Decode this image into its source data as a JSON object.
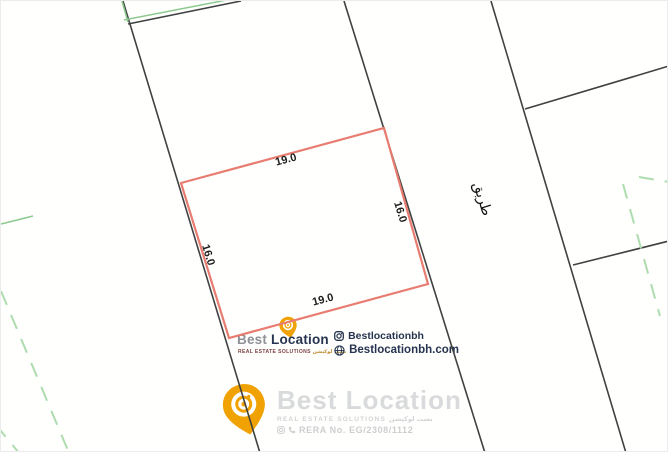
{
  "colors": {
    "plot-red": "#e87c70",
    "parcel-line": "#404242",
    "green-solid": "#8cc98c",
    "green-dash": "#aedcae",
    "brand-orange": "#f0a202",
    "brand-navy": "#26344f",
    "brand-gray": "#8e9196",
    "watermark-gray": "#d9dadb"
  },
  "plot": {
    "dim_top": "19.0",
    "dim_bottom": "19.0",
    "dim_left": "16.0",
    "dim_right": "16.0"
  },
  "map": {
    "road_label": "طريق"
  },
  "watermark": {
    "brand_first": "Best",
    "brand_second": "Location",
    "tagline_en": "REAL ESTATE SOLUTIONS",
    "tagline_ar": "بست لوكيشن",
    "instagram_handle": "Bestlocationbh",
    "website": "Bestlocationbh.com"
  },
  "footer": {
    "brand": "Best Location",
    "tagline_en": "REAL ESTATE SOLUTIONS",
    "tagline_ar": "بست لوكيشن",
    "rera": "RERA No. EG/2308/1112"
  }
}
